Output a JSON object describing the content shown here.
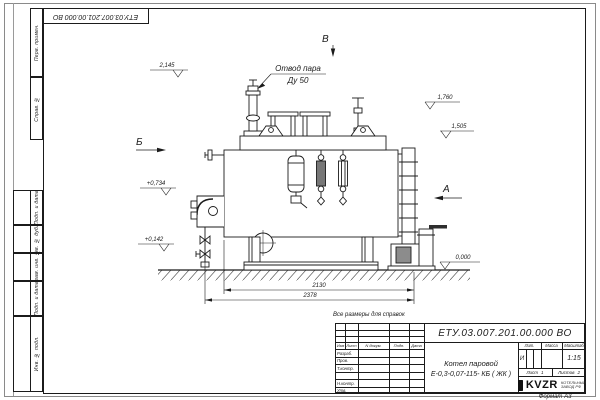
{
  "sheet": {
    "stamp_top": "ЕТУ.03.007.201.00.000 ВО",
    "format_note": "Формат А3",
    "reference_note": "Все размеры для справок",
    "side_columns": [
      "Перв. примен.",
      "Справ. №",
      "Подп. и дата",
      "Инв. № дубл.",
      "Взам. инв. №",
      "Подп. и дата",
      "Инв. № подл."
    ]
  },
  "drawing": {
    "labels": {
      "steam_outlet_line1": "Отвод пара",
      "steam_outlet_line2": "Ду 50"
    },
    "views": {
      "left": "Б",
      "top": "В",
      "right": "А"
    },
    "elevations": {
      "e2145": "2,145",
      "e1760": "1,760",
      "e1505": "1,505",
      "e0734": "+0,734",
      "e0142": "+0,142",
      "e0000": "0,000"
    },
    "dimensions": {
      "inner": "2130",
      "overall": "2378"
    }
  },
  "title_block": {
    "doc_number": "ЕТУ.03.007.201.00.000  ВО",
    "product_line1": "Котел паровой",
    "product_line2": "Е-0,3-0,07-115- КБ ( ЖК )",
    "header_cols": [
      "Изм",
      "Лист",
      "N докум.",
      "Подп.",
      "Дата"
    ],
    "rows": [
      "Разраб.",
      "Пров.",
      "Т.контр.",
      "",
      "Н.контр.",
      "Утв."
    ],
    "lit_header": "Лит.",
    "lit_value": "И",
    "mass_header": "Масса",
    "scale_header": "Масштаб",
    "scale_value": "1:15",
    "sheet_label": "Лист",
    "sheet_value": "1",
    "sheets_label": "Листов",
    "sheets_value": "2",
    "logo_text": "KVZR",
    "logo_sub1": "КОТЕЛЬНЫЙ",
    "logo_sub2": "ЗАВОД РФ"
  }
}
